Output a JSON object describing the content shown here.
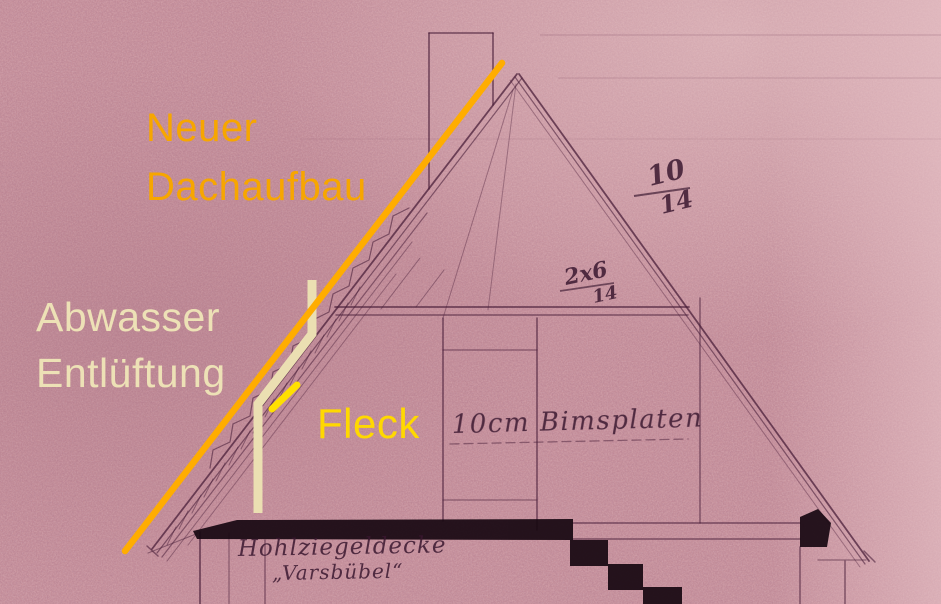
{
  "annotations": {
    "new_roof": {
      "line1": "Neuer",
      "line2": "Dachaufbau",
      "color": "#F7A600"
    },
    "vent": {
      "line1": "Abwasser",
      "line2": "Entlüftung",
      "color": "#EDE1B6"
    },
    "fleck": {
      "label": "Fleck",
      "color": "#FFD800"
    }
  },
  "drawing": {
    "labels": {
      "bims": "10cm Bimsplaten",
      "ceiling": "Hohlziegeldecke",
      "ceiling_brand": "„Varsbübel“",
      "rafter_dim_num": "10",
      "rafter_dim_den": "14",
      "collar_dim_num": "2x6",
      "collar_dim_den": "14"
    }
  },
  "markers": {
    "new_roof_line_color": "#FFAD00",
    "vent_pipe_color": "#EBDFB2",
    "fleck_dash_color": "#FFE000"
  },
  "paper": {
    "base_color": "#c9939d",
    "pencil_color": "#4a1f3a"
  }
}
